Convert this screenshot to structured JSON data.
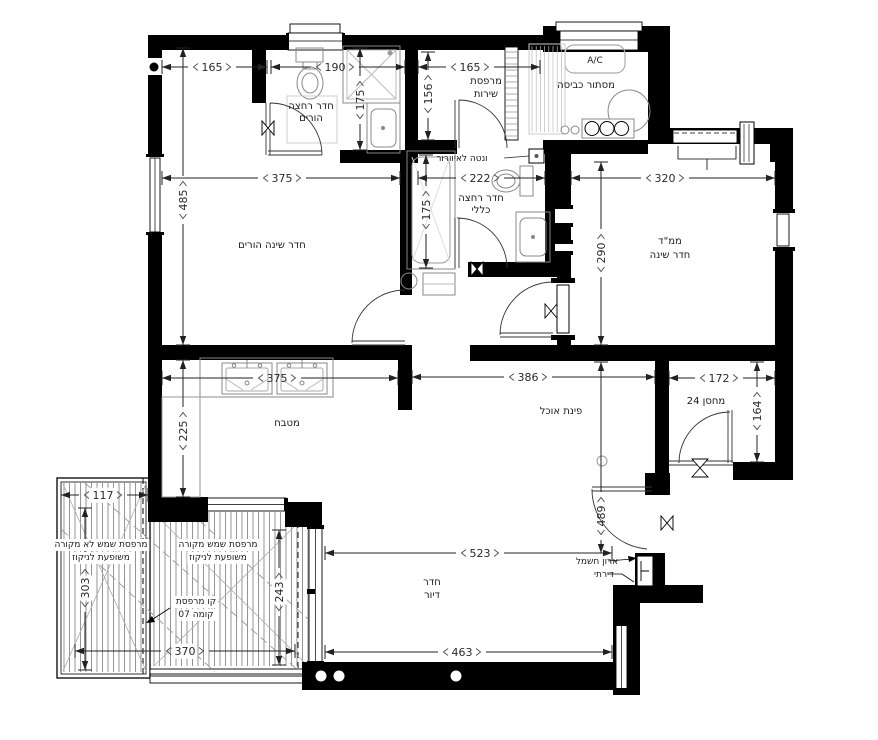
{
  "rooms": {
    "parents_bath": {
      "line1": "חדר רחצה",
      "line2": "הורים"
    },
    "service_balcony": {
      "line1": "מרפסת",
      "line2": "שירות"
    },
    "laundry": {
      "label": "מסתור כביסה"
    },
    "ac": {
      "label": "A/C"
    },
    "vent": {
      "label": "ונטה לאיוורור"
    },
    "general_bath": {
      "line1": "חדר רחצה",
      "line2": "כללי"
    },
    "mamad": {
      "line1": "ממ\"ד",
      "line2": "חדר שינה"
    },
    "parents_bedroom": {
      "label": "חדר שינה הורים"
    },
    "kitchen": {
      "label": "מטבח"
    },
    "dining": {
      "label": "פינת אוכל"
    },
    "storage": {
      "label": "מחסן 24"
    },
    "balcony_uncovered": {
      "line1": "מרפסת שמש לא מקורה",
      "line2": "משופעת לניקוז"
    },
    "balcony_covered": {
      "line1": "מרפסת שמש מקורה",
      "line2": "משופעת לניקוז"
    },
    "balcony_line": {
      "line1": "קו מרפסת",
      "line2": "קומה 07"
    },
    "living": {
      "line1": "חדר",
      "line2": "דיור"
    },
    "electrical": {
      "line1": "ארון חשמל",
      "line2": "דירתי"
    }
  },
  "dims": {
    "bedroom_top": "165",
    "bath1_top": "190",
    "bath1_depth": "175",
    "service_w": "165",
    "service_d": "156",
    "bath2_w": "222",
    "bath2_tub": "175",
    "mamad_w": "320",
    "mamad_d": "290",
    "bedroom_w": "375",
    "bedroom_d": "485",
    "kitchen_w": "375",
    "kitchen_d": "225",
    "dining_w": "386",
    "hall_d": "489",
    "storage_w": "172",
    "storage_d": "164",
    "balc1_w": "117",
    "balc1_d": "303",
    "balc2_d": "243",
    "balc2_w": "370",
    "living_w": "523",
    "living_w2": "463"
  },
  "colors": {
    "wall": "#000000",
    "fixture": "#888888",
    "dim": "#222222"
  }
}
